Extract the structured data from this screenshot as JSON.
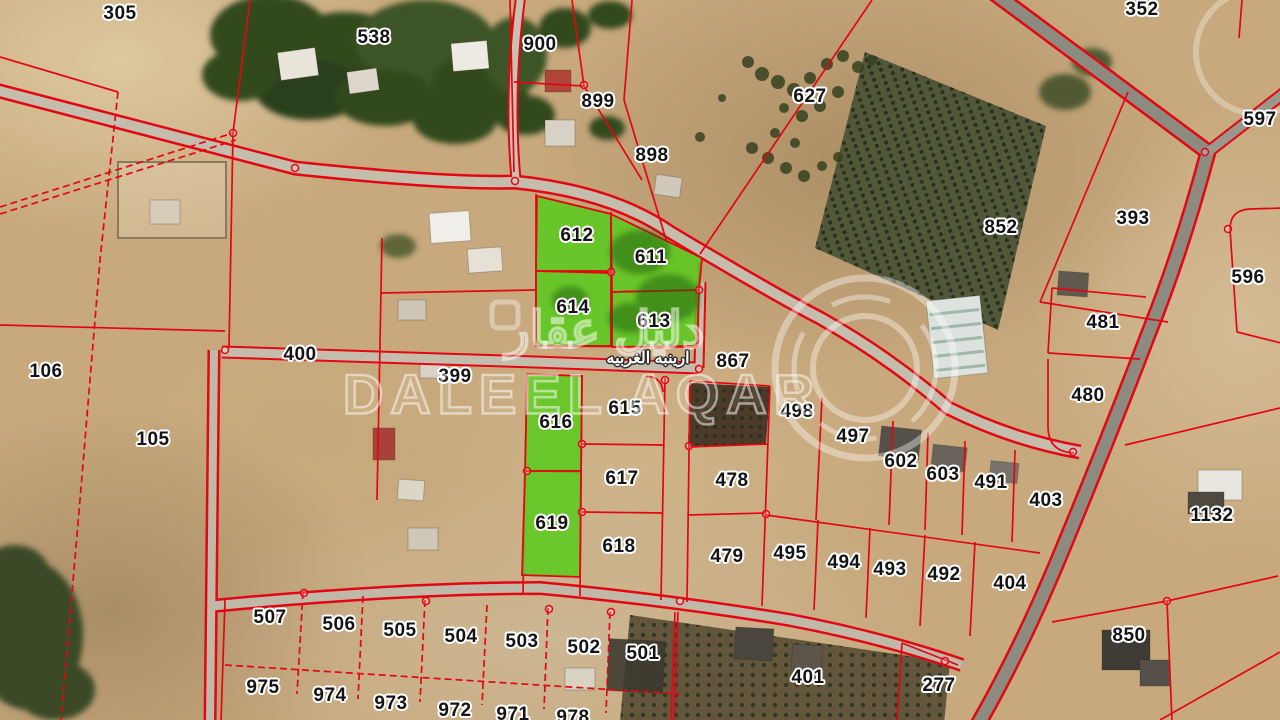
{
  "map": {
    "street_name": "ارينبه الغربيه",
    "watermark": {
      "arabic": "دليل عقار",
      "latin": "DALEEL AQAR"
    },
    "colors": {
      "boundary_red": "#e30613",
      "highlight_green": "#54cc17",
      "terrain_tan": "#c9a97d",
      "road_gray": "#c4bdac",
      "highway_gray": "#8d8a80",
      "label_ink": "#141414",
      "label_halo": "#ffffff"
    },
    "highlighted_parcels": [
      "611",
      "612",
      "613",
      "614",
      "616",
      "619"
    ],
    "parcel_labels": [
      {
        "n": "305",
        "x": 120,
        "y": 14
      },
      {
        "n": "538",
        "x": 374,
        "y": 38
      },
      {
        "n": "900",
        "x": 540,
        "y": 45
      },
      {
        "n": "899",
        "x": 598,
        "y": 102
      },
      {
        "n": "898",
        "x": 652,
        "y": 156
      },
      {
        "n": "352",
        "x": 1142,
        "y": 10
      },
      {
        "n": "627",
        "x": 810,
        "y": 97
      },
      {
        "n": "597",
        "x": 1260,
        "y": 120
      },
      {
        "n": "393",
        "x": 1133,
        "y": 219
      },
      {
        "n": "852",
        "x": 1001,
        "y": 228
      },
      {
        "n": "596",
        "x": 1248,
        "y": 278
      },
      {
        "n": "481",
        "x": 1103,
        "y": 323
      },
      {
        "n": "612",
        "x": 577,
        "y": 236
      },
      {
        "n": "611",
        "x": 651,
        "y": 258
      },
      {
        "n": "614",
        "x": 573,
        "y": 308
      },
      {
        "n": "613",
        "x": 654,
        "y": 322
      },
      {
        "n": "400",
        "x": 300,
        "y": 355
      },
      {
        "n": "399",
        "x": 455,
        "y": 377
      },
      {
        "n": "867",
        "x": 733,
        "y": 362
      },
      {
        "n": "106",
        "x": 46,
        "y": 372
      },
      {
        "n": "105",
        "x": 153,
        "y": 440
      },
      {
        "n": "616",
        "x": 556,
        "y": 423
      },
      {
        "n": "615",
        "x": 625,
        "y": 409
      },
      {
        "n": "498",
        "x": 797,
        "y": 412
      },
      {
        "n": "497",
        "x": 853,
        "y": 437
      },
      {
        "n": "480",
        "x": 1088,
        "y": 396
      },
      {
        "n": "602",
        "x": 901,
        "y": 462
      },
      {
        "n": "603",
        "x": 943,
        "y": 475
      },
      {
        "n": "491",
        "x": 991,
        "y": 483
      },
      {
        "n": "403",
        "x": 1046,
        "y": 501
      },
      {
        "n": "1132",
        "x": 1212,
        "y": 516
      },
      {
        "n": "617",
        "x": 622,
        "y": 479
      },
      {
        "n": "478",
        "x": 732,
        "y": 481
      },
      {
        "n": "619",
        "x": 552,
        "y": 524
      },
      {
        "n": "618",
        "x": 619,
        "y": 547
      },
      {
        "n": "479",
        "x": 727,
        "y": 557
      },
      {
        "n": "495",
        "x": 790,
        "y": 554
      },
      {
        "n": "494",
        "x": 844,
        "y": 563
      },
      {
        "n": "493",
        "x": 890,
        "y": 570
      },
      {
        "n": "492",
        "x": 944,
        "y": 575
      },
      {
        "n": "404",
        "x": 1010,
        "y": 584
      },
      {
        "n": "850",
        "x": 1129,
        "y": 636
      },
      {
        "n": "507",
        "x": 270,
        "y": 618
      },
      {
        "n": "506",
        "x": 339,
        "y": 625
      },
      {
        "n": "505",
        "x": 400,
        "y": 631
      },
      {
        "n": "504",
        "x": 461,
        "y": 637
      },
      {
        "n": "503",
        "x": 522,
        "y": 642
      },
      {
        "n": "502",
        "x": 584,
        "y": 648
      },
      {
        "n": "501",
        "x": 643,
        "y": 654
      },
      {
        "n": "401",
        "x": 808,
        "y": 678
      },
      {
        "n": "277",
        "x": 939,
        "y": 686
      },
      {
        "n": "975",
        "x": 263,
        "y": 688
      },
      {
        "n": "974",
        "x": 330,
        "y": 696
      },
      {
        "n": "973",
        "x": 391,
        "y": 704
      },
      {
        "n": "972",
        "x": 455,
        "y": 711
      },
      {
        "n": "971",
        "x": 513,
        "y": 715
      },
      {
        "n": "978",
        "x": 573,
        "y": 718
      }
    ]
  }
}
